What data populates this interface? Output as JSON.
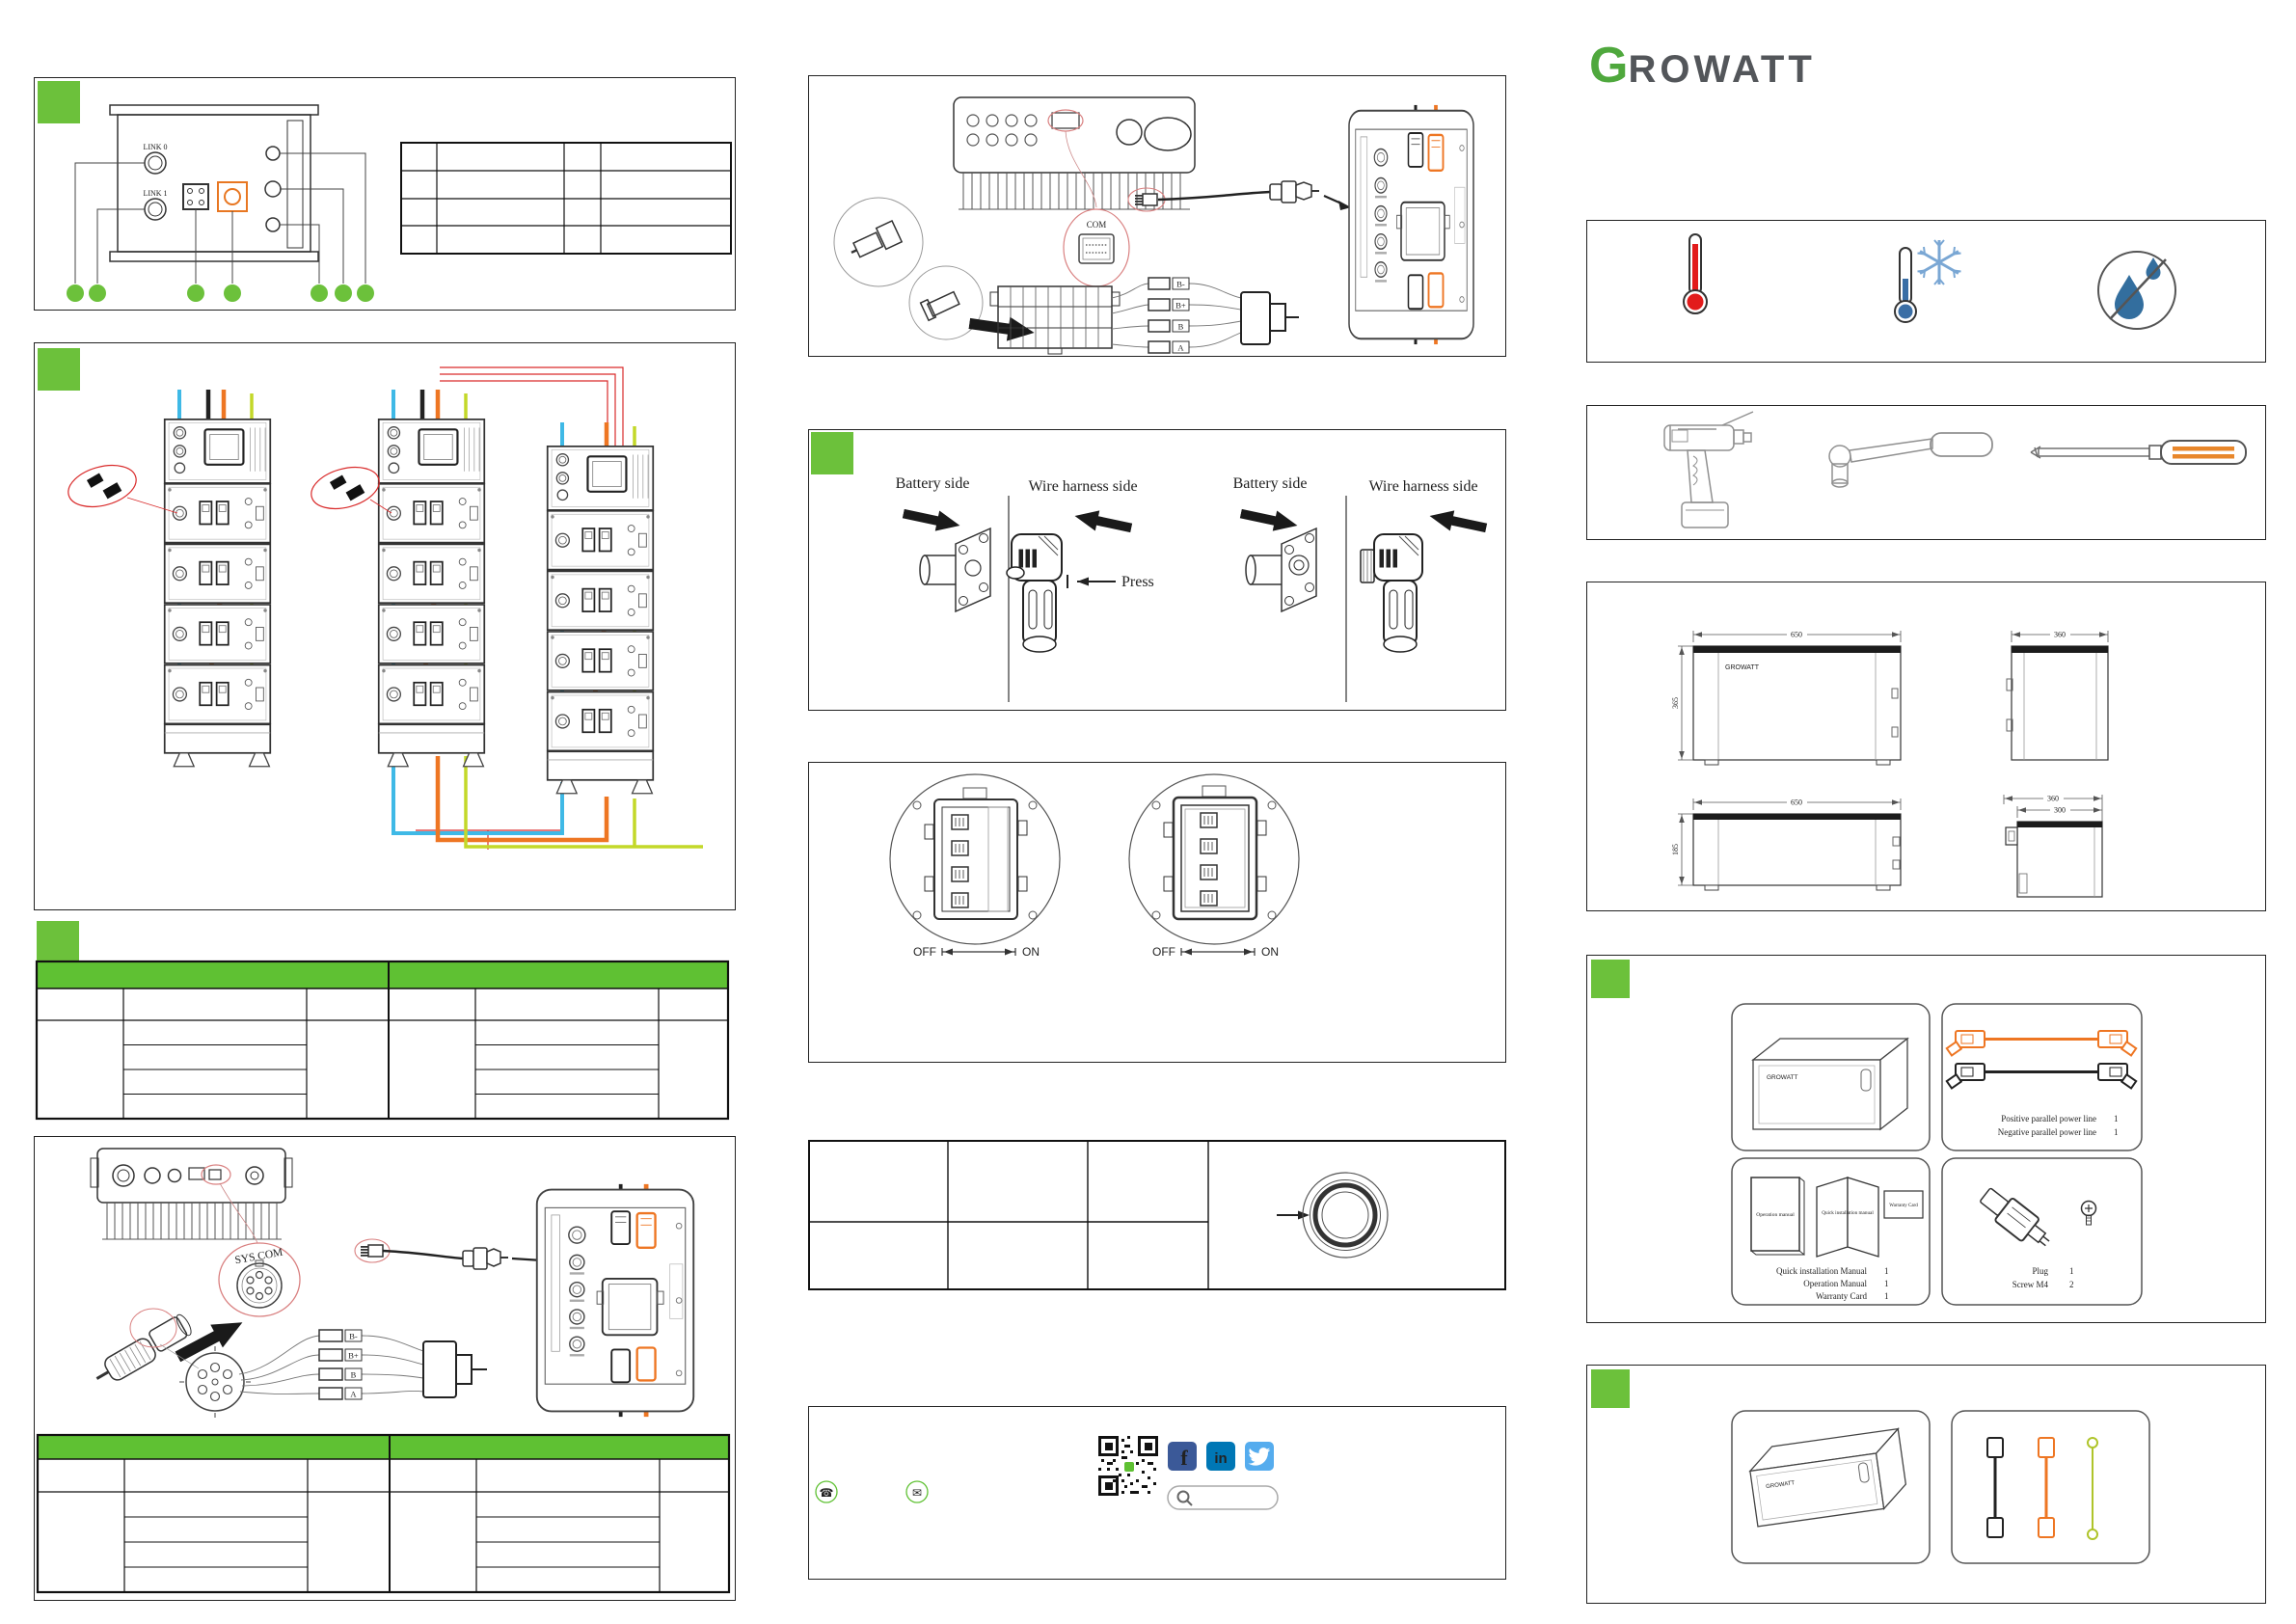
{
  "logo": {
    "g": "G",
    "rest": "ROWATT",
    "full": "GROWATT"
  },
  "device_panel": {
    "link0": "LINK 0",
    "link1": "LINK 1"
  },
  "press_panel": {
    "battery_side": "Battery side",
    "wire_harness_side": "Wire harness side",
    "press": "Press"
  },
  "breaker_panel": {
    "off": "OFF",
    "on": "ON"
  },
  "syscom_panel": {
    "port_label": "SYS COM",
    "harness_labels": [
      "B-",
      "B+",
      "B",
      "A"
    ]
  },
  "com_panel": {
    "port_label": "COM",
    "harness_labels": [
      "B-",
      "B+",
      "B",
      "A"
    ]
  },
  "dimensions": {
    "unit_width": "650",
    "unit_height": "365",
    "unit_depth": "360",
    "module_width": "650",
    "module_height": "185",
    "module_depth": "360",
    "module_depth_inner": "300"
  },
  "packing_list": {
    "cable_card": {
      "items": [
        {
          "label": "Positive parallel power line",
          "qty": "1"
        },
        {
          "label": "Negative parallel power line",
          "qty": "1"
        }
      ]
    },
    "docs_card": {
      "operation_manual": "Operation manual",
      "quick_manual": "Quick installation manual",
      "warranty_card": "Warranty Card",
      "items": [
        {
          "label": "Quick installation Manual",
          "qty": "1"
        },
        {
          "label": "Operation Manual",
          "qty": "1"
        },
        {
          "label": "Warranty Card",
          "qty": "1"
        }
      ]
    },
    "plug_card": {
      "items": [
        {
          "label": "Plug",
          "qty": "1"
        },
        {
          "label": "Screw M4",
          "qty": "2"
        }
      ]
    }
  },
  "contact_panel": {
    "phone_glyph": "☎",
    "mail_glyph": "✉",
    "facebook_glyph": "f",
    "linkedin_glyph": "in",
    "search_value": ""
  }
}
